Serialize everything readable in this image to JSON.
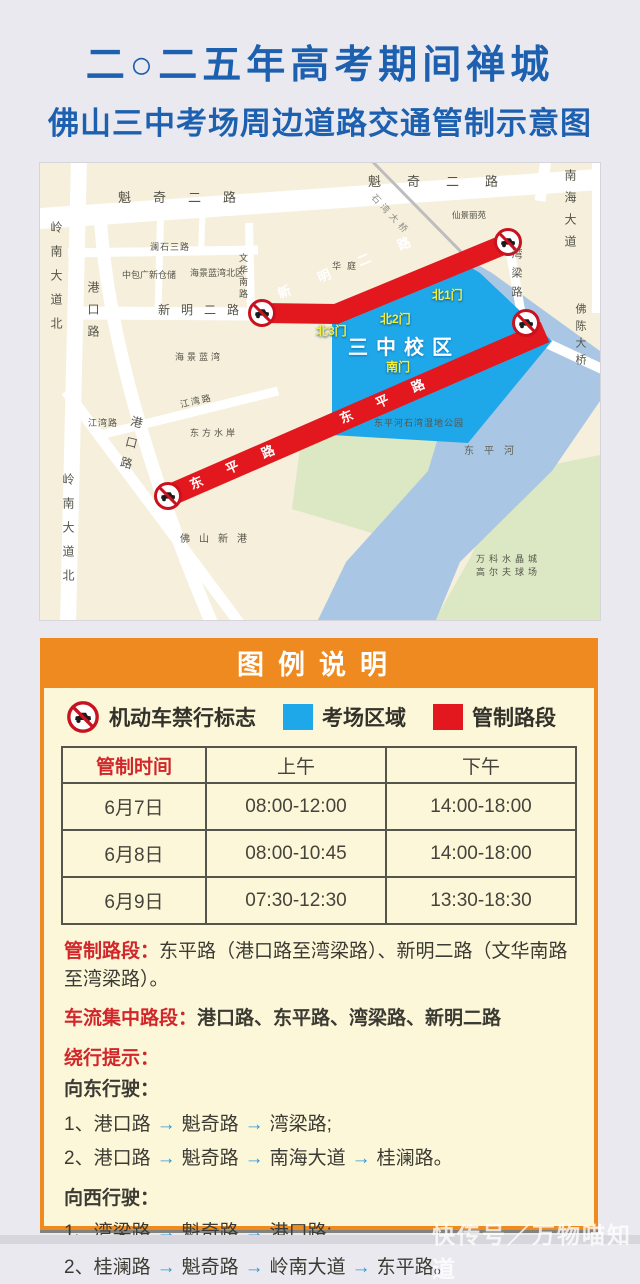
{
  "title": {
    "line1": "二○二五年高考期间禅城",
    "line2": "佛山三中考场周边道路交通管制示意图"
  },
  "map": {
    "school_area_color": "#1fa8e9",
    "restricted_color": "#e3181e",
    "labels": {
      "kuiqi_er_lu": "魁奇二路",
      "lingnan_dadao_bei": "岭南大道北",
      "gangkou_lu": "港口路",
      "xinming_er_lu": "新明二路",
      "lanshi_san_lu": "澜石三路",
      "zhongbao_cangchu": "中包广新仓储",
      "haijing_lanwan_beiqu": "海景蓝湾北区",
      "wenhua_nan_lu": "文华南路",
      "hua_ting": "华庭",
      "haijing_lanwan": "海景蓝湾",
      "jiangwan_lu": "江湾路",
      "dongfang_shuian": "东方水岸",
      "foshan_xingang": "佛山新港",
      "wetland_park": "东平河石湾湿地公园",
      "dongping_he": "东平河",
      "vanke_line1": "万科水晶城",
      "vanke_line2": "高尔夫球场",
      "wanliang_lu": "湾梁路",
      "nanhai_dadao": "南海大道",
      "fochen_daqiao": "佛陈大桥",
      "xianjing_liyuan": "仙景丽苑",
      "shiwan_daqiao": "石湾大桥",
      "school": "三中校区",
      "gate_north1": "北1门",
      "gate_north2": "北2门",
      "gate_north3": "北3门",
      "gate_south": "南门",
      "band_xinming": "新明二路",
      "band_dongping": "东平路"
    }
  },
  "legend": {
    "header": "图例说明",
    "items": [
      {
        "label": "机动车禁行标志"
      },
      {
        "label": "考场区域",
        "color": "#1fa8e9"
      },
      {
        "label": "管制路段",
        "color": "#e3181e"
      }
    ]
  },
  "table": {
    "headers": [
      "管制时间",
      "上午",
      "下午"
    ],
    "rows": [
      [
        "6月7日",
        "08:00-12:00",
        "14:00-18:00"
      ],
      [
        "6月8日",
        "08:00-10:45",
        "14:00-18:00"
      ],
      [
        "6月9日",
        "07:30-12:30",
        "13:30-18:30"
      ]
    ]
  },
  "notes": {
    "restricted_label": "管制路段：",
    "restricted_text": "东平路（港口路至湾梁路）、新明二路（文华南路至湾梁路）。",
    "busy_label": "车流集中路段：",
    "busy_text": "港口路、东平路、湾梁路、新明二路",
    "detour_label": "绕行提示：",
    "arrow": "→",
    "east_label": "向东行驶：",
    "east_routes": [
      {
        "num": "1、",
        "stops": [
          "港口路",
          "魁奇路",
          "湾梁路;"
        ]
      },
      {
        "num": "2、",
        "stops": [
          "港口路",
          "魁奇路",
          "南海大道",
          "桂澜路。"
        ]
      }
    ],
    "west_label": "向西行驶：",
    "west_routes": [
      {
        "num": "1、",
        "stops": [
          "湾梁路",
          "魁奇路",
          "港口路;"
        ]
      },
      {
        "num": "2、",
        "stops": [
          "桂澜路",
          "魁奇路",
          "岭南大道",
          "东平路。"
        ]
      }
    ]
  },
  "watermark": "快传号／万物喵知道"
}
